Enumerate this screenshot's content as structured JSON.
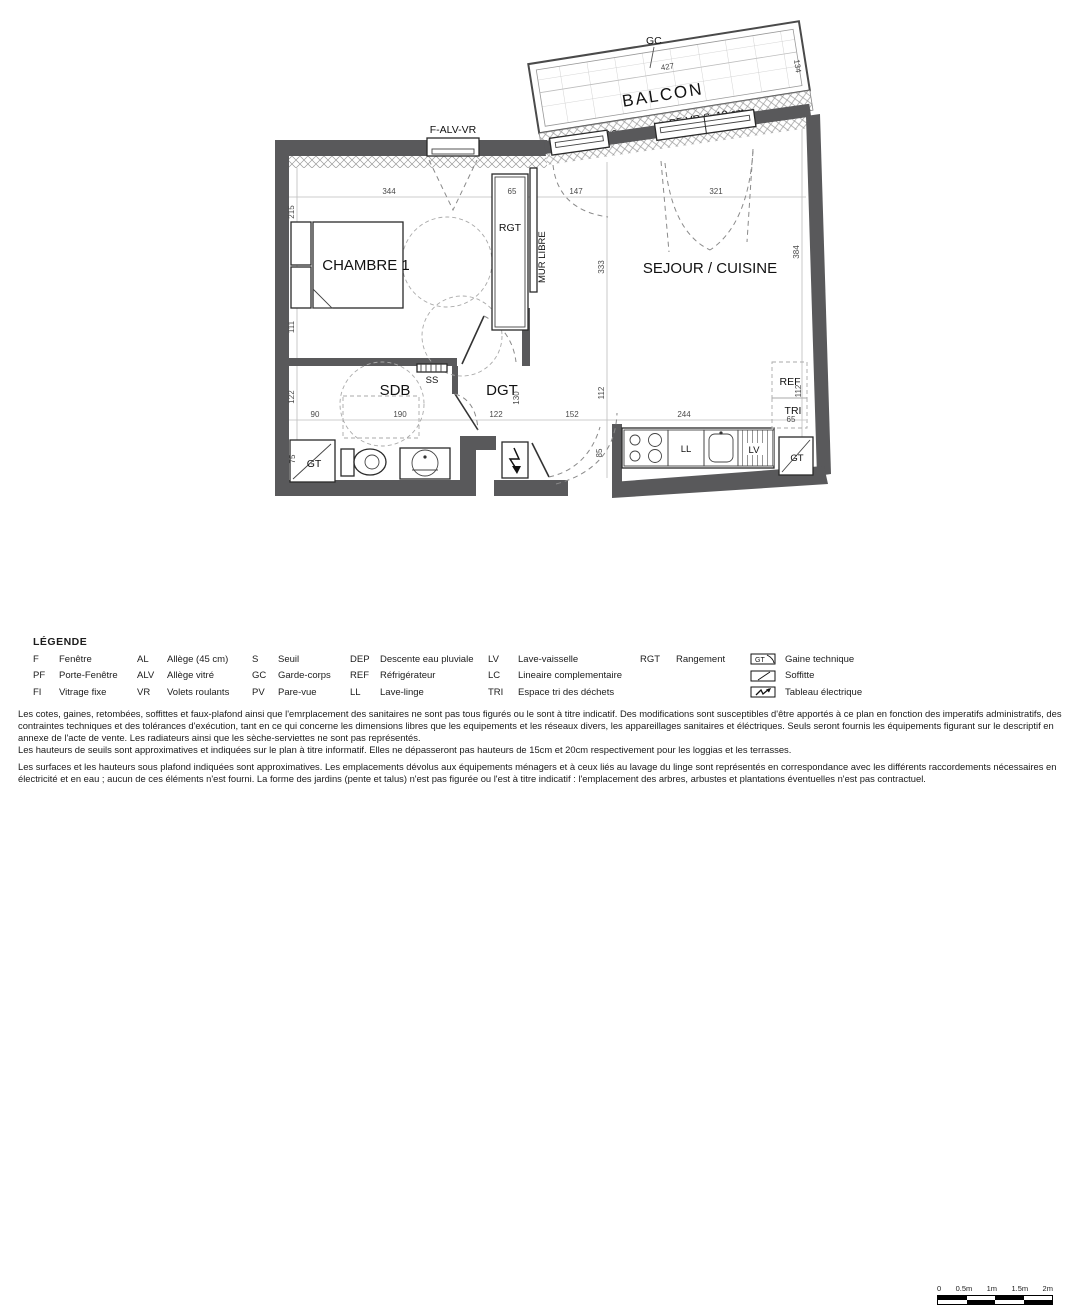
{
  "plan": {
    "rooms": {
      "balcon": "BALCON",
      "chambre": "CHAMBRE 1",
      "sejour": "SEJOUR / CUISINE",
      "sdb": "SDB",
      "dgt": "DGT"
    },
    "labels": {
      "gc": "GC",
      "f_alv_vr": "F-ALV-VR",
      "pf_vr_a": "PF-VR  S=18 cm",
      "pf_vr_b": "PF-VR  S=18 cm",
      "mur_libre": "MUR LIBRE",
      "rgt": "RGT",
      "ss": "SS",
      "ref": "REF",
      "tri": "TRI",
      "ll": "LL",
      "lv": "LV",
      "gt_left": "GT",
      "gt_right": "GT"
    },
    "dims": {
      "d427": "427",
      "d134": "134",
      "d344": "344",
      "d65a": "65",
      "d147": "147",
      "d321": "321",
      "d215": "215",
      "d111": "111",
      "d122v": "122",
      "d75": "75",
      "d90": "90",
      "d190": "190",
      "d122h": "122",
      "d130": "130",
      "d152": "152",
      "d333": "333",
      "d384": "384",
      "d112a": "112",
      "d85": "85",
      "d244": "244",
      "d112b": "112",
      "d65b": "65"
    }
  },
  "legend": {
    "title": "LÉGENDE",
    "columns": [
      {
        "items": [
          {
            "abbr": "F",
            "label": "Fenêtre"
          },
          {
            "abbr": "PF",
            "label": "Porte-Fenêtre"
          },
          {
            "abbr": "FI",
            "label": "Vitrage fixe"
          }
        ]
      },
      {
        "items": [
          {
            "abbr": "AL",
            "label": "Allège (45 cm)"
          },
          {
            "abbr": "ALV",
            "label": "Allège vitré"
          },
          {
            "abbr": "VR",
            "label": "Volets roulants"
          }
        ]
      },
      {
        "items": [
          {
            "abbr": "S",
            "label": "Seuil"
          },
          {
            "abbr": "GC",
            "label": "Garde-corps"
          },
          {
            "abbr": "PV",
            "label": "Pare-vue"
          }
        ]
      },
      {
        "items": [
          {
            "abbr": "DEP",
            "label": "Descente eau pluviale"
          },
          {
            "abbr": "REF",
            "label": "Réfrigérateur"
          },
          {
            "abbr": "LL",
            "label": "Lave-linge"
          }
        ]
      },
      {
        "items": [
          {
            "abbr": "LV",
            "label": "Lave-vaisselle"
          },
          {
            "abbr": "LC",
            "label": "Lineaire complementaire"
          },
          {
            "abbr": "TRI",
            "label": "Espace tri des déchets"
          }
        ]
      },
      {
        "items": [
          {
            "abbr": "RGT",
            "label": "Rangement"
          }
        ]
      }
    ],
    "symbols": [
      {
        "glyph": "GT",
        "label": "Gaine technique"
      },
      {
        "label": "Soffitte"
      },
      {
        "label": "Tableau électrique"
      }
    ]
  },
  "scalebar": {
    "ticks": [
      "0",
      "0.5m",
      "1m",
      "1.5m",
      "2m"
    ]
  },
  "disclaimer": {
    "p1": "Les cotes, gaines, retombées, soffittes et faux-plafond ainsi que l'emrplacement des sanitaires ne sont  pas tous figurés ou le sont à titre indicatif. Des modifications sont susceptibles d'être apportés à ce plan en fonction des imperatifs administratifs, des contraintes techniques et des tolérances d'exécution, tant en ce qui concerne les dimensions libres que les equipements et les réseaux divers, les appareillages sanitaires et éléctriques. Seuls seront fournis les équipements figurant sur le descriptif en annexe de l'acte de vente. Les radiateurs ainsi que les sèche-serviettes ne sont pas représentés.",
    "p2": "Les hauteurs de seuils sont approximatives et indiquées sur le plan à titre informatif. Elles ne dépasseront pas hauteurs de 15cm et 20cm respectivement pour les loggias et les terrasses.",
    "p3": "Les surfaces et les hauteurs sous plafond indiquées sont approximatives. Les emplacements dévolus aux équipements ménagers et à ceux liés au lavage du linge sont représentés en correspondance avec les différents raccordements nécessaires en électricité et en eau ; aucun de ces éléments n'est fourni. La forme des jardins (pente et talus) n'est pas figurée ou l'est à titre indicatif : l'emplacement des arbres, arbustes et plantations éventuelles n'est pas contractuel."
  },
  "colors": {
    "wall": "#59595b",
    "hatch": "#9a9a9a",
    "dim_text": "#4a4a4a",
    "text": "#111111"
  }
}
